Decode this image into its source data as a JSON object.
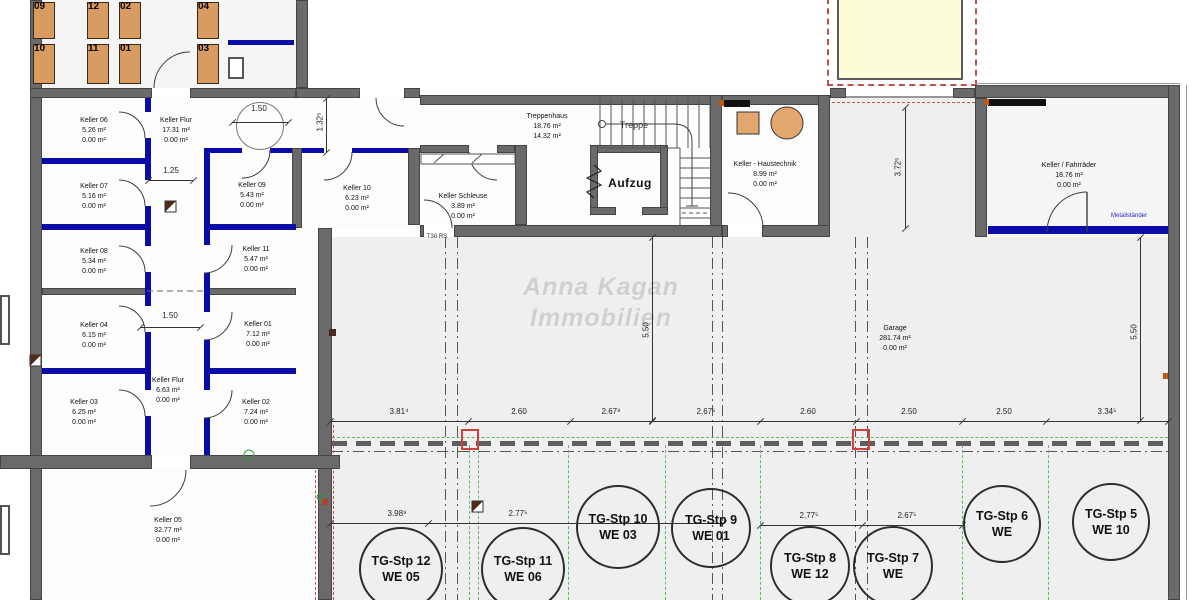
{
  "watermark": {
    "line1": "Anna Kagan",
    "line2": "Immobilien"
  },
  "lockers": {
    "top": [
      "09",
      "12",
      "02",
      "04"
    ],
    "bottom": [
      "10",
      "11",
      "01",
      "03"
    ]
  },
  "rooms": [
    {
      "name": "Keller 06",
      "a1": "5.26 m²",
      "a2": "0.00 m²"
    },
    {
      "name": "Keller Flur",
      "a1": "17.31 m²",
      "a2": "0.00 m²"
    },
    {
      "name": "Keller 07",
      "a1": "5.16 m²",
      "a2": "0.00 m²"
    },
    {
      "name": "Keller 09",
      "a1": "5.43 m²",
      "a2": "0.00 m²"
    },
    {
      "name": "Keller 10",
      "a1": "6.23 m²",
      "a2": "0.00 m²"
    },
    {
      "name": "Keller 08",
      "a1": "5.34 m²",
      "a2": "0.00 m²"
    },
    {
      "name": "Keller 11",
      "a1": "5.47 m²",
      "a2": "0.00 m²"
    },
    {
      "name": "Keller 04",
      "a1": "6.15 m²",
      "a2": "0.00 m²"
    },
    {
      "name": "Keller 01",
      "a1": "7.12 m²",
      "a2": "0.00 m²"
    },
    {
      "name": "Keller Flur",
      "a1": "6.63 m²",
      "a2": "0.00 m²"
    },
    {
      "name": "Keller 03",
      "a1": "6.25 m²",
      "a2": "0.00 m²"
    },
    {
      "name": "Keller 02",
      "a1": "7.24 m²",
      "a2": "0.00 m²"
    },
    {
      "name": "Keller 05",
      "a1": "32.77 m²",
      "a2": "0.00 m²"
    },
    {
      "name": "Treppenhaus",
      "a1": "18.76 m²",
      "a2": "14.32 m²"
    },
    {
      "name": "Keller Schleuse",
      "a1": "3.89 m²",
      "a2": "0.00 m²"
    },
    {
      "name": "Keller - Haustechnik",
      "a1": "8.99 m²",
      "a2": "0.00 m²"
    },
    {
      "name": "Keller / Fahrräder",
      "a1": "18.76 m²",
      "a2": "0.00 m²"
    },
    {
      "name": "Garage",
      "a1": "281.74 m²",
      "a2": "0.00 m²"
    }
  ],
  "labels": {
    "elevator": "Aufzug",
    "stairs": "Treppe",
    "fire_door": "T30 RS",
    "bike_rack": "Metallständer"
  },
  "parking": [
    {
      "stp": "TG-Stp 12",
      "we": "WE 05"
    },
    {
      "stp": "TG-Stp 11",
      "we": "WE 06"
    },
    {
      "stp": "TG-Stp 10",
      "we": "WE 03"
    },
    {
      "stp": "TG-Stp 9",
      "we": "WE 01"
    },
    {
      "stp": "TG-Stp 8",
      "we": "WE 12"
    },
    {
      "stp": "TG-Stp 7",
      "we": "WE"
    },
    {
      "stp": "TG-Stp 6",
      "we": "WE"
    },
    {
      "stp": "TG-Stp 5",
      "we": "WE 10"
    }
  ],
  "dimensions": {
    "garage_row": [
      "3.81⁴",
      "2.60",
      "2.67⁸",
      "2.67⁵",
      "2.60",
      "2.50",
      "2.50",
      "3.34⁵"
    ],
    "parking_row": [
      "3.98⁹",
      "2.77⁵",
      "2.77⁵",
      "2.67⁵"
    ],
    "vertical_center": "5.50",
    "vertical_right": "5.50",
    "vertical_ramp": "3.72⁵",
    "vertical_entry": "1.32⁵",
    "flur_top": "1.50",
    "flur_width": "1.25",
    "flur_mid": "1.50"
  },
  "colors": {
    "wall": "#6a6a6a",
    "partition_blue": "#0b0ba6",
    "locker_fill": "#d89b62",
    "ramp_fill": "#fbfbd8",
    "dashed_red": "#c0504d",
    "dashed_green": "#62b862",
    "watermark": "#d0d0d0"
  }
}
